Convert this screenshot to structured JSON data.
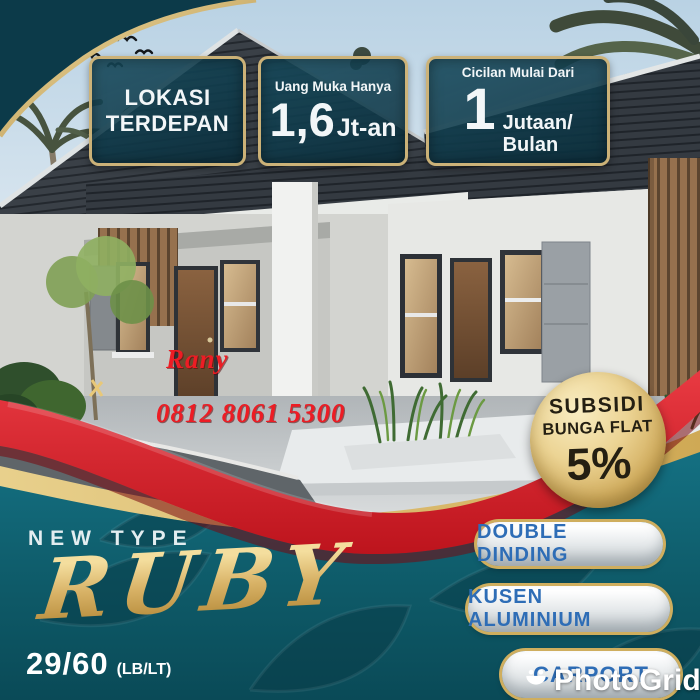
{
  "poster": {
    "top_badges": [
      {
        "lines": [
          "LOKASI",
          "TERDEPAN"
        ]
      },
      {
        "caption": "Uang Muka Hanya",
        "value": "1,6",
        "unit": "Jt-an"
      },
      {
        "caption": "Cicilan Mulai Dari",
        "value": "1",
        "unit_lines": [
          "Jutaan/",
          "Bulan"
        ]
      }
    ],
    "agent": {
      "name": "Rany",
      "phone": "0812 8061 5300"
    },
    "subsidy_badge": {
      "line1": "SUBSIDI",
      "line2": "BUNGA FLAT",
      "rate": "5%"
    },
    "type_section": {
      "kicker": "NEW TYPE",
      "type_name": "RUBY",
      "size": "29/60",
      "size_label": "(LB/LT)"
    },
    "features": [
      "DOUBLE DINDING",
      "KUSEN ALUMINIUM",
      "CARPORT"
    ],
    "watermark": {
      "icon": "photogrid-bowl-icon",
      "label": "PhotoGrid"
    },
    "colors": {
      "teal_swoosh": "#0c3a49",
      "teal_panel": "#0f5e6c",
      "badge_teal": "#123e4e",
      "gold_trim": "#d4b269",
      "gold_band": "#d9bc6e",
      "red_ribbon": "#d6202b",
      "red_text": "#ed1c24",
      "feature_blue": "#2e6db6",
      "gold_script": "#dcb76a",
      "white_text": "#f2f6f8",
      "subsidy_text": "#241f12"
    }
  }
}
